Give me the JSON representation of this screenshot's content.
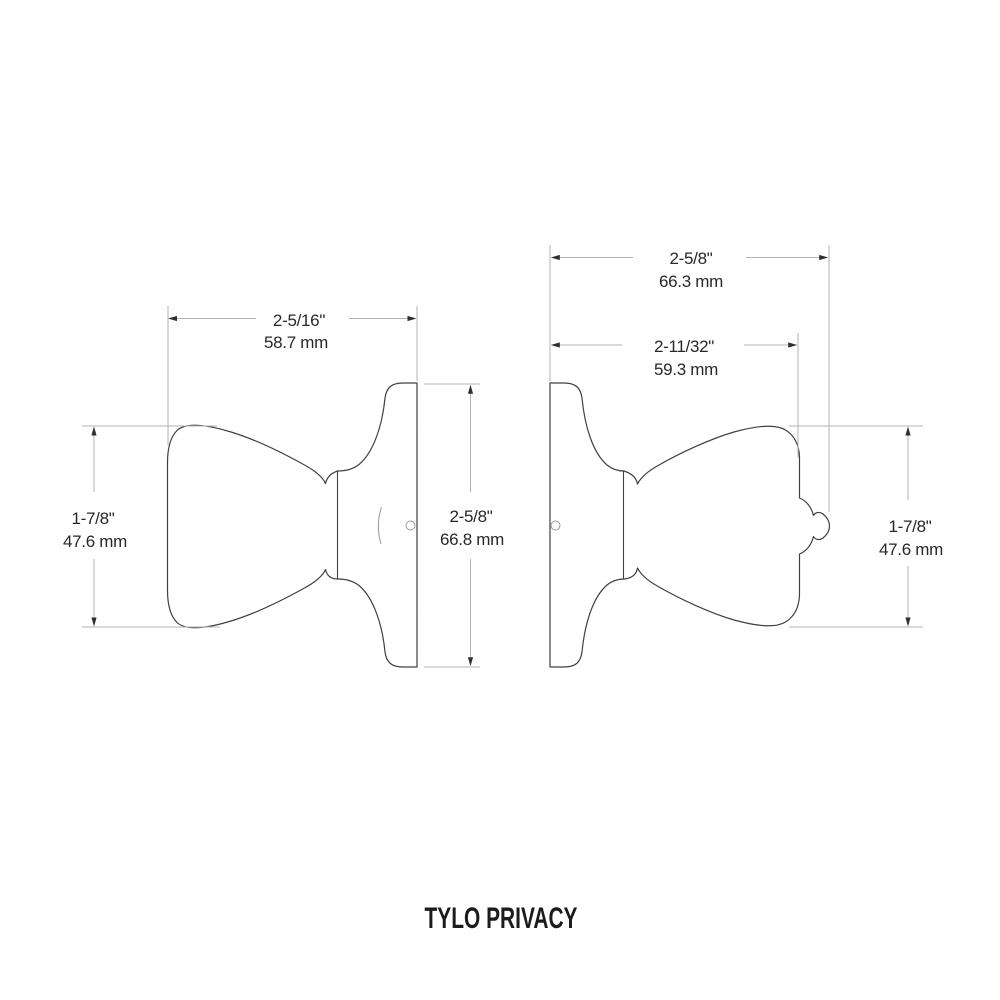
{
  "title": "TYLO PRIVACY",
  "drawing": {
    "left_view": {
      "width": {
        "inch": "2-5/16\"",
        "mm": "58.7 mm"
      },
      "height": {
        "inch": "1-7/8\"",
        "mm": "47.6 mm"
      },
      "rose_diameter": {
        "inch": "2-5/8\"",
        "mm": "66.8 mm"
      }
    },
    "right_view": {
      "overall_projection": {
        "inch": "2-5/8\"",
        "mm": "66.3 mm"
      },
      "knob_projection": {
        "inch": "2-11/32\"",
        "mm": "59.3 mm"
      },
      "height": {
        "inch": "1-7/8\"",
        "mm": "47.6 mm"
      }
    },
    "colors": {
      "background": "#ffffff",
      "outline": "#404040",
      "dimension_lines": "#b3b3b3",
      "arrowheads": "#2f2f2f",
      "text": "#282828"
    }
  }
}
